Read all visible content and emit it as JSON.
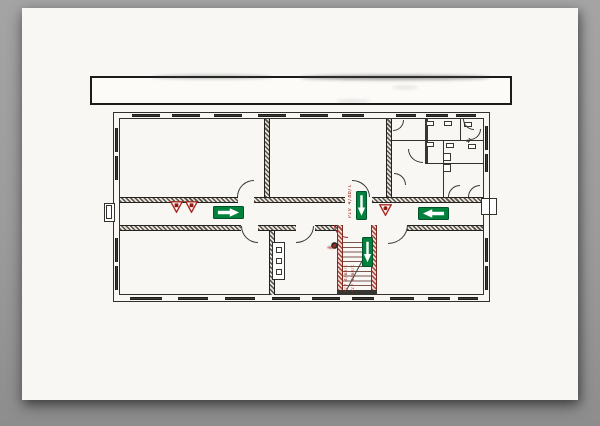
{
  "scene": {
    "background_color": "#9b9b9b",
    "page_color": "#f8f7f4",
    "description": "Scanned evacuation floor plan sheet lying on a gray surface"
  },
  "title_block": {
    "text": ""
  },
  "plan": {
    "colors": {
      "ink": "#33312d",
      "exit_green": "#00813c",
      "safety_red": "#a8271e"
    },
    "labels": {
      "corridor_code": "PIV 4/BB/C",
      "stair_code_1": "PIV 4/BB/C",
      "stair_code_2": "PIV 4/BB/C",
      "room_number": "4"
    },
    "symbols": [
      {
        "name": "exit-arrow-right-icon",
        "color": "#00813c"
      },
      {
        "name": "exit-arrow-left-icon",
        "color": "#00813c"
      },
      {
        "name": "exit-arrow-down-icon",
        "color": "#00813c"
      },
      {
        "name": "fire-extinguisher-icon",
        "color": "#a8271e"
      },
      {
        "name": "fire-point-icon",
        "color": "#a8271e"
      }
    ]
  }
}
